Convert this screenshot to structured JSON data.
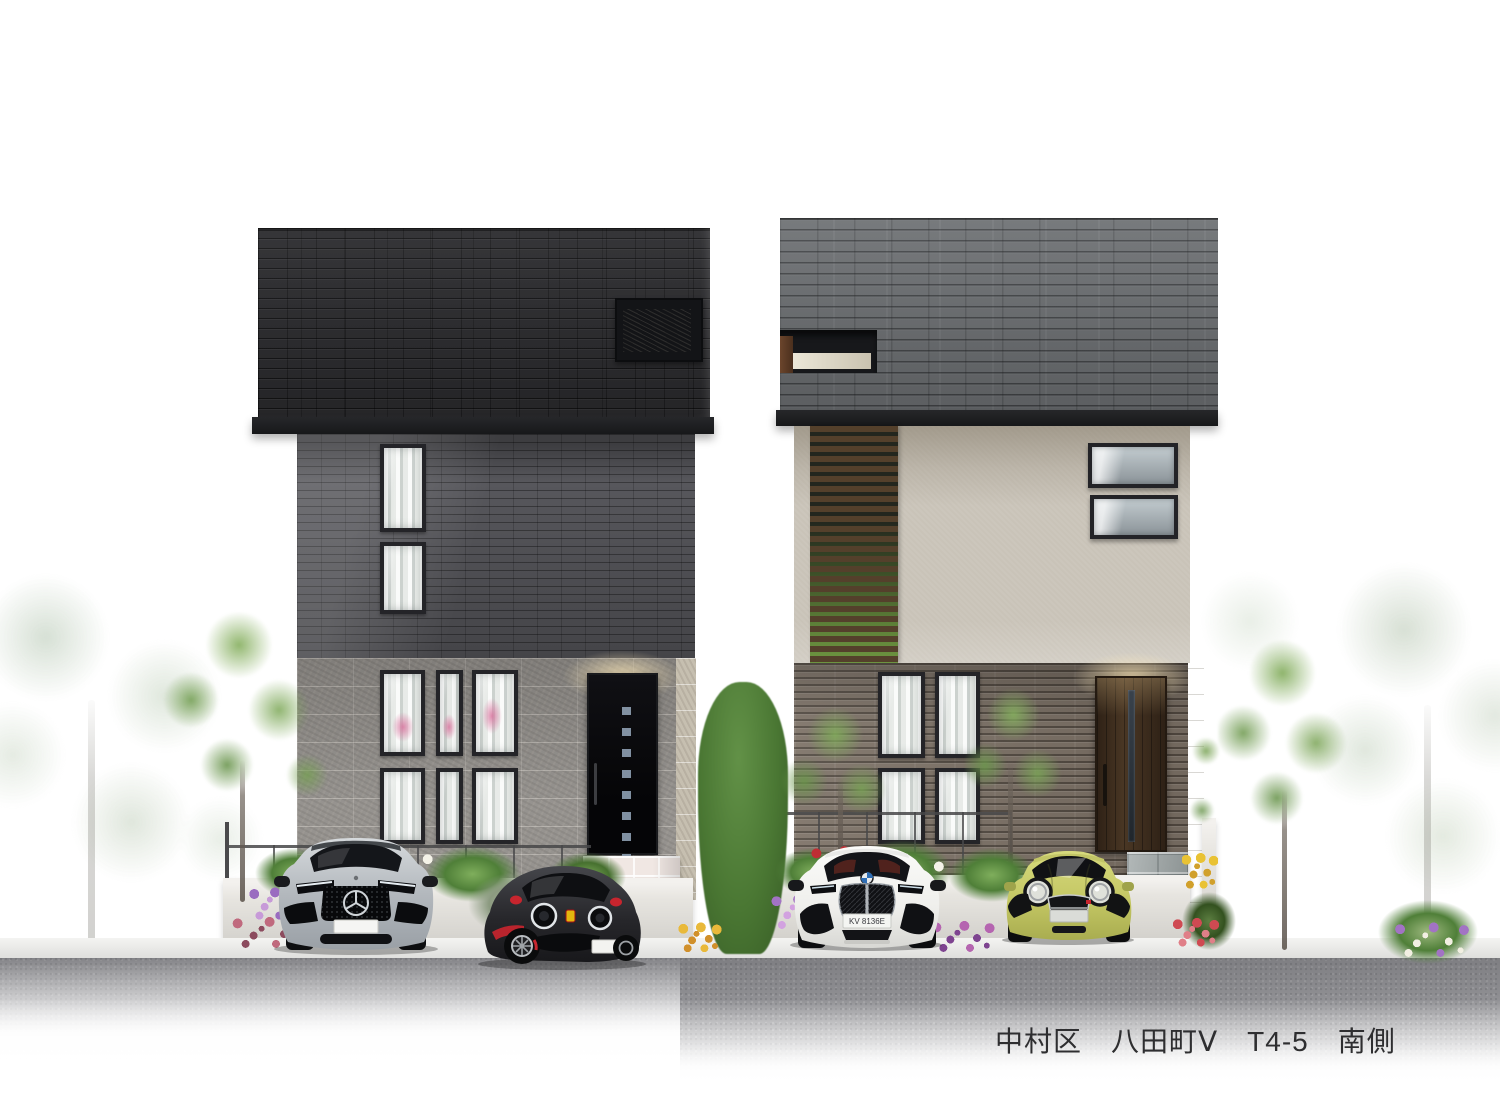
{
  "caption": {
    "text": "中村区　八田町Ⅴ　T4-5　南側"
  },
  "scene": {
    "type": "architectural-elevation-rendering",
    "view_label": "南側",
    "district_label": "中村区",
    "town_label": "八田町Ⅴ",
    "lot_label": "T4-5"
  },
  "houses": {
    "left": {
      "roof": "black flat brick-tile upper volume with recessed window",
      "upper_wall": "dark gray brick",
      "lower_wall": "gray split-face stone",
      "door": "black entrance door with 7 square lites",
      "windows": "tall slot windows 2F, 3x2 window group 1F"
    },
    "right": {
      "roof": "gray slate tile volume with recessed slit opening",
      "upper_wall": "beige stucco with dark brown wood slat screen",
      "lower_wall": "brown-gray horizontal brick",
      "door": "dark brown entrance door with vertical lite",
      "windows": "two awning windows 2F, 2x2 window group 1F"
    }
  },
  "cars": {
    "mercedes": {
      "model": "silver luxury SUV",
      "color": "#b9bdc2",
      "plate": ""
    },
    "abarth": {
      "model": "dark compact hatch with red accents",
      "color": "#2c2c30",
      "plate": ""
    },
    "bmw": {
      "model": "white SUV with black kidney grille",
      "color": "#f2f2f0",
      "plate": "KV 8136E"
    },
    "mini": {
      "model": "lime-yellow compact",
      "color": "#c9cc6a",
      "plate": ""
    }
  },
  "palette": {
    "background": "#ffffff",
    "left_roof": "#2b2b2e",
    "left_upper_wall": "#57575c",
    "left_lower_wall": "#8f8c88",
    "right_roof": "#6c6f72",
    "right_upper_wall": "#c9c3b8",
    "right_lower_wall": "#7c7166",
    "wood_slats": "#54402b",
    "garden_wall": "#e7e5e0",
    "asphalt": "#98989b",
    "caption_text": "#2e2e30"
  }
}
